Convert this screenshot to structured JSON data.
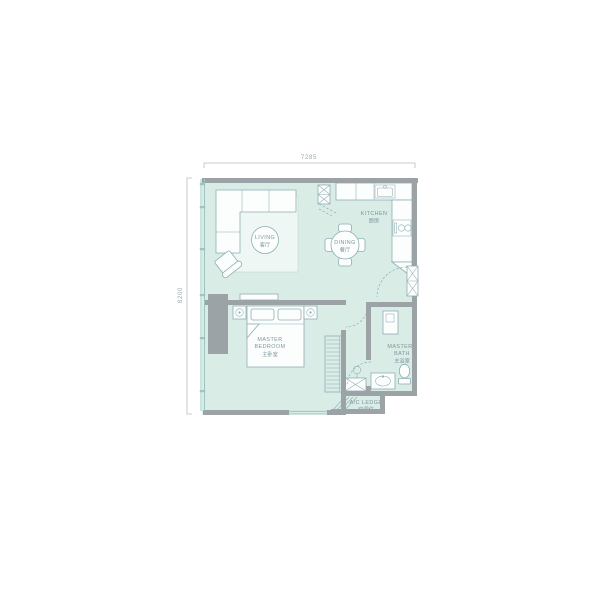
{
  "plan": {
    "dimensions": {
      "top": "7285",
      "left": "8200"
    },
    "rooms": {
      "living": {
        "name": "LIVING",
        "name_zh": "客厅"
      },
      "dining": {
        "name": "DINING",
        "name_zh": "餐厅"
      },
      "kitchen": {
        "name": "KITCHEN",
        "name_zh": "厨房"
      },
      "master_bedroom": {
        "name_line1": "MASTER",
        "name_line2": "BEDROOM",
        "name_zh": "主卧室"
      },
      "master_bath": {
        "name_line1": "MASTER",
        "name_line2": "BATH",
        "name_zh": "主浴室"
      },
      "ac_ledge": {
        "name": "A/C LEDGE",
        "name_zh": "空调位"
      }
    },
    "colors": {
      "floor": "#d9ece6",
      "wall": "#9ba3a7",
      "outline": "#8fadb3",
      "window": "#9cc5be",
      "rug": "#eef7f3",
      "text": "#7b969c",
      "dimension": "#b3bec1",
      "dimtext": "#9aa8ac"
    }
  }
}
